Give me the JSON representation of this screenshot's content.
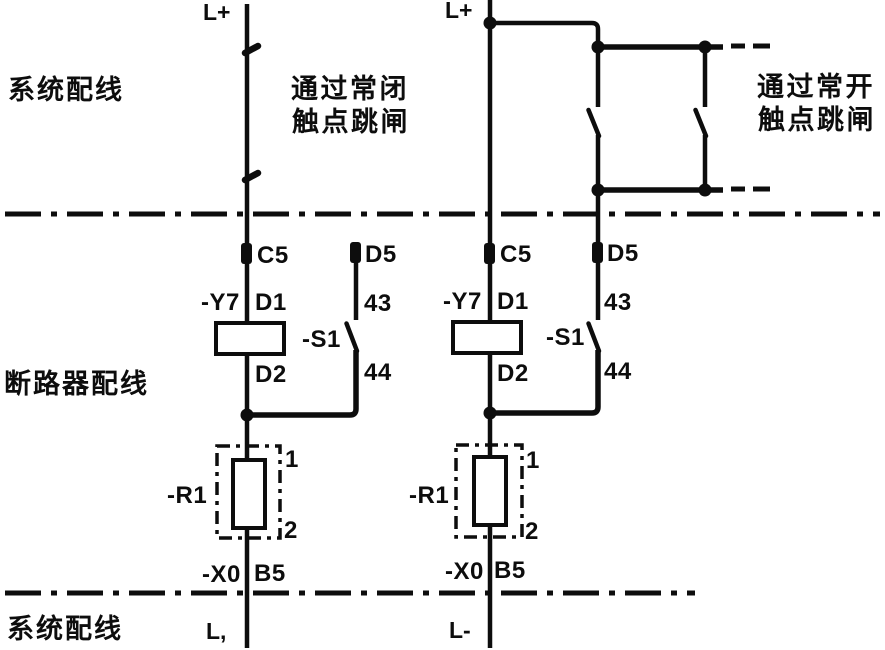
{
  "colors": {
    "ink": "#0d0d0d",
    "paper": "#ffffff"
  },
  "zones": {
    "system_wiring_top": "系统配线",
    "breaker_wiring": "断路器配线",
    "system_wiring_bottom": "系统配线"
  },
  "captions": {
    "nc_line1": "通过常闭",
    "nc_line2": "触点跳闸",
    "no_line1": "通过常开",
    "no_line2": "触点跳闸"
  },
  "left": {
    "supply_top": "L+",
    "c5": "C5",
    "d5": "D5",
    "coil": "-Y7",
    "d1": "D1",
    "d2": "D2",
    "s1": "-S1",
    "k43": "43",
    "k44": "44",
    "r1": "-R1",
    "p1": "1",
    "p2": "2",
    "x0": "-X0",
    "b5": "B5",
    "supply_bottom": "L,"
  },
  "right": {
    "supply_top": "L+",
    "c5": "C5",
    "d5": "D5",
    "coil": "-Y7",
    "d1": "D1",
    "d2": "D2",
    "s1": "-S1",
    "k43": "43",
    "k44": "44",
    "r1": "-R1",
    "p1": "1",
    "p2": "2",
    "x0": "-X0",
    "b5": "B5",
    "supply_bottom": "L-"
  }
}
